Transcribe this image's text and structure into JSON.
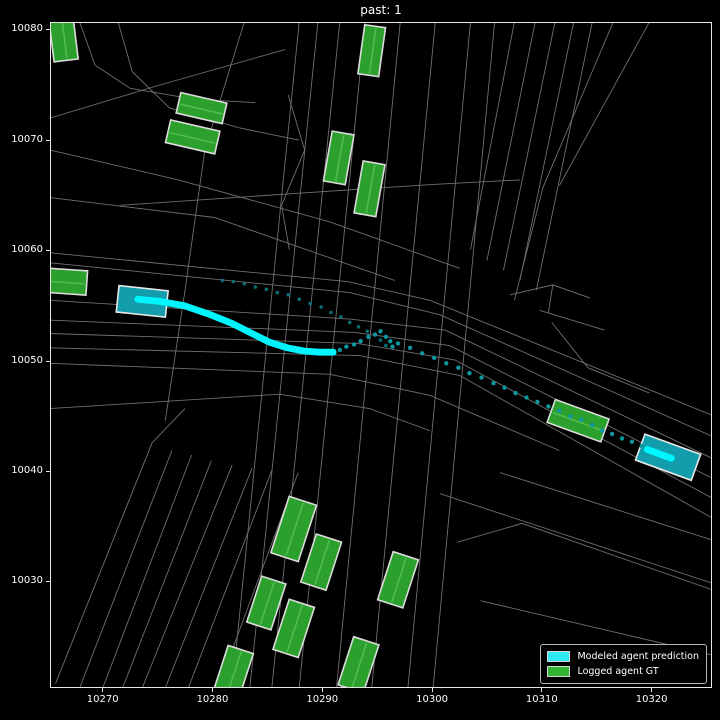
{
  "title": "past: 1",
  "legend": {
    "items": [
      {
        "label": "Modeled agent prediction",
        "color": "#2ee9f4"
      },
      {
        "label": "Logged agent GT",
        "color": "#33b433"
      }
    ]
  },
  "chart_data": {
    "type": "scatter",
    "title": "past: 1",
    "xlim": [
      10265.2,
      10325.5
    ],
    "ylim": [
      10020.4,
      10080.7
    ],
    "xticks": [
      10270,
      10280,
      10290,
      10300,
      10310,
      10320
    ],
    "yticks": [
      10030,
      10040,
      10050,
      10060,
      10070,
      10080
    ],
    "grid": false,
    "legend_position": "lower right",
    "colors": {
      "background": "#000000",
      "road": "#6f6f6f",
      "gt_fill": "#2ca02c",
      "gt_stripe": "#55bf55",
      "gt_edge": "#dcdcdc",
      "pred_fill": "#129cac",
      "pred_edge": "#e8e8e8",
      "pred_bright": "#00f6ff",
      "axis": "#e8e8e8",
      "text": "#ffffff"
    },
    "roads": [
      [
        [
          10265.2,
          10059.8
        ],
        [
          10292.3,
          10057.2
        ],
        [
          10299.8,
          10055.5
        ],
        [
          10325.5,
          10045.1
        ]
      ],
      [
        [
          10265.2,
          10058.9
        ],
        [
          10292.5,
          10056.2
        ],
        [
          10300.7,
          10054.2
        ],
        [
          10325.5,
          10043.2
        ]
      ],
      [
        [
          10265.2,
          10055.5
        ],
        [
          10292.5,
          10053.8
        ],
        [
          10301.2,
          10052.8
        ],
        [
          10325.5,
          10041.2
        ]
      ],
      [
        [
          10265.2,
          10053.7
        ],
        [
          10293.0,
          10052.6
        ],
        [
          10301.6,
          10051.4
        ],
        [
          10325.5,
          10039.4
        ]
      ],
      [
        [
          10265.2,
          10052.5
        ],
        [
          10293.2,
          10051.6
        ],
        [
          10302.1,
          10050.1
        ],
        [
          10325.5,
          10037.6
        ]
      ],
      [
        [
          10265.2,
          10051.2
        ],
        [
          10293.4,
          10050.5
        ],
        [
          10302.5,
          10048.7
        ],
        [
          10325.5,
          10035.8
        ]
      ],
      [
        [
          10265.2,
          10049.8
        ],
        [
          10290.7,
          10048.8
        ],
        [
          10299.8,
          10046.9
        ],
        [
          10311.6,
          10041.9
        ]
      ],
      [
        [
          10265.2,
          10045.7
        ],
        [
          10286.1,
          10047.0
        ],
        [
          10294.3,
          10045.7
        ],
        [
          10299.8,
          10043.7
        ]
      ],
      [
        [
          10300.7,
          10038.0
        ],
        [
          10325.5,
          10029.9
        ]
      ],
      [
        [
          10306.2,
          10039.9
        ],
        [
          10325.5,
          10033.8
        ]
      ],
      [
        [
          10302.3,
          10033.6
        ],
        [
          10308.2,
          10035.3
        ],
        [
          10325.5,
          10029.3
        ]
      ],
      [
        [
          10304.4,
          10028.3
        ],
        [
          10325.5,
          10023.4
        ]
      ],
      [
        [
          10287.9,
          10080.7
        ],
        [
          10281.8,
          10020.4
        ]
      ],
      [
        [
          10289.6,
          10080.7
        ],
        [
          10283.4,
          10020.4
        ]
      ],
      [
        [
          10291.6,
          10080.7
        ],
        [
          10285.4,
          10020.4
        ]
      ],
      [
        [
          10293.9,
          10080.7
        ],
        [
          10287.9,
          10020.4
        ]
      ],
      [
        [
          10297.1,
          10080.7
        ],
        [
          10291.3,
          10020.4
        ]
      ],
      [
        [
          10300.3,
          10080.7
        ],
        [
          10294.5,
          10020.4
        ]
      ],
      [
        [
          10303.5,
          10080.7
        ],
        [
          10297.8,
          10020.4
        ]
      ],
      [
        [
          10305.7,
          10080.7
        ],
        [
          10300.1,
          10020.4
        ]
      ],
      [
        [
          10282.9,
          10080.7
        ],
        [
          10279.3,
          10069.1
        ],
        [
          10277.5,
          10056.4
        ],
        [
          10275.7,
          10044.6
        ]
      ],
      [
        [
          10307.5,
          10080.7
        ],
        [
          10303.5,
          10060.1
        ]
      ],
      [
        [
          10309.4,
          10080.7
        ],
        [
          10305.0,
          10059.1
        ]
      ],
      [
        [
          10311.2,
          10080.7
        ],
        [
          10306.5,
          10058.2
        ]
      ],
      [
        [
          10312.9,
          10080.7
        ],
        [
          10308.0,
          10057.3
        ]
      ],
      [
        [
          10314.6,
          10080.7
        ],
        [
          10309.5,
          10056.4
        ]
      ],
      [
        [
          10316.5,
          10080.7
        ],
        [
          10310.1,
          10065.7
        ],
        [
          10307.5,
          10055.5
        ]
      ],
      [
        [
          10319.8,
          10080.7
        ],
        [
          10311.6,
          10065.9
        ]
      ],
      [
        [
          10277.5,
          10045.7
        ],
        [
          10274.5,
          10042.6
        ],
        [
          10265.7,
          10020.8
        ]
      ],
      [
        [
          10276.3,
          10041.9
        ],
        [
          10267.9,
          10020.4
        ]
      ],
      [
        [
          10278.1,
          10041.5
        ],
        [
          10270.0,
          10020.4
        ]
      ],
      [
        [
          10279.9,
          10041.0
        ],
        [
          10271.8,
          10020.4
        ]
      ],
      [
        [
          10281.8,
          10040.6
        ],
        [
          10273.6,
          10020.4
        ]
      ],
      [
        [
          10283.6,
          10040.3
        ],
        [
          10275.7,
          10020.4
        ]
      ],
      [
        [
          10285.4,
          10040.1
        ],
        [
          10277.8,
          10020.4
        ]
      ],
      [
        [
          10287.8,
          10039.9
        ],
        [
          10280.5,
          10020.4
        ]
      ],
      [
        [
          10265.2,
          10072.0
        ],
        [
          10275.2,
          10075.0
        ],
        [
          10286.6,
          10078.2
        ]
      ],
      [
        [
          10267.9,
          10080.7
        ],
        [
          10269.3,
          10076.8
        ],
        [
          10272.5,
          10074.7
        ],
        [
          10278.4,
          10073.7
        ],
        [
          10283.9,
          10073.4
        ]
      ],
      [
        [
          10271.4,
          10080.7
        ],
        [
          10272.7,
          10076.2
        ],
        [
          10276.1,
          10072.9
        ],
        [
          10282.5,
          10071.1
        ],
        [
          10287.9,
          10070.0
        ]
      ],
      [
        [
          10265.2,
          10069.1
        ],
        [
          10276.9,
          10066.4
        ],
        [
          10290.7,
          10062.6
        ],
        [
          10302.5,
          10058.4
        ]
      ],
      [
        [
          10265.2,
          10064.8
        ],
        [
          10280.2,
          10063.0
        ],
        [
          10293.4,
          10058.4
        ],
        [
          10296.6,
          10057.3
        ]
      ],
      [
        [
          10271.6,
          10064.1
        ],
        [
          10287.9,
          10065.2
        ],
        [
          10300.1,
          10066.0
        ],
        [
          10308.0,
          10066.4
        ]
      ],
      [
        [
          10286.9,
          10074.1
        ],
        [
          10288.4,
          10069.1
        ],
        [
          10286.3,
          10064.1
        ],
        [
          10287.0,
          10060.1
        ]
      ],
      [
        [
          10307.1,
          10056.0
        ],
        [
          10311.0,
          10056.9
        ],
        [
          10314.4,
          10055.7
        ]
      ],
      [
        [
          10311.0,
          10056.9
        ],
        [
          10310.6,
          10054.4
        ]
      ],
      [
        [
          10310.9,
          10053.5
        ],
        [
          10314.2,
          10049.4
        ],
        [
          10319.8,
          10047.1
        ]
      ],
      [
        [
          10309.8,
          10054.6
        ],
        [
          10315.7,
          10052.8
        ]
      ]
    ],
    "gt_boxes": [
      {
        "cx": 10266.4,
        "cy": 10079.4,
        "length": 4.4,
        "width": 2.2,
        "heading": 97
      },
      {
        "cx": 10266.7,
        "cy": 10057.2,
        "length": 3.7,
        "width": 2.2,
        "heading": -4
      },
      {
        "cx": 10279.0,
        "cy": 10072.9,
        "length": 4.3,
        "width": 1.9,
        "heading": -13
      },
      {
        "cx": 10278.2,
        "cy": 10070.3,
        "length": 4.6,
        "width": 2.1,
        "heading": -13
      },
      {
        "cx": 10294.5,
        "cy": 10078.1,
        "length": 4.5,
        "width": 1.9,
        "heading": 82
      },
      {
        "cx": 10291.5,
        "cy": 10068.4,
        "length": 4.6,
        "width": 2.0,
        "heading": 80
      },
      {
        "cx": 10294.3,
        "cy": 10065.6,
        "length": 4.8,
        "width": 2.0,
        "heading": 80
      },
      {
        "cx": 10287.4,
        "cy": 10034.8,
        "length": 5.4,
        "width": 2.6,
        "heading": 72
      },
      {
        "cx": 10289.9,
        "cy": 10031.8,
        "length": 4.6,
        "width": 2.4,
        "heading": 72
      },
      {
        "cx": 10284.9,
        "cy": 10028.1,
        "length": 4.4,
        "width": 2.3,
        "heading": 72
      },
      {
        "cx": 10287.4,
        "cy": 10025.8,
        "length": 4.8,
        "width": 2.4,
        "heading": 72
      },
      {
        "cx": 10296.9,
        "cy": 10030.2,
        "length": 4.6,
        "width": 2.4,
        "heading": 72
      },
      {
        "cx": 10293.3,
        "cy": 10022.5,
        "length": 4.6,
        "width": 2.4,
        "heading": 72
      },
      {
        "cx": 10281.9,
        "cy": 10021.8,
        "length": 4.4,
        "width": 2.4,
        "heading": 72
      },
      {
        "cx": 10313.3,
        "cy": 10044.6,
        "length": 5.2,
        "width": 2.2,
        "heading": -20
      }
    ],
    "pred_boxes": [
      {
        "cx": 10273.6,
        "cy": 10055.4,
        "length": 4.5,
        "width": 2.4,
        "heading": -6
      },
      {
        "cx": 10321.5,
        "cy": 10041.3,
        "length": 5.4,
        "width": 2.5,
        "heading": -20
      }
    ],
    "trajectories": [
      {
        "name": "past-dotted-trajectory",
        "style": "dots",
        "radius": 0.16,
        "color": "#0a6d77",
        "points": [
          [
            10280.9,
            10057.3
          ],
          [
            10281.9,
            10057.2
          ],
          [
            10282.9,
            10057.0
          ],
          [
            10283.9,
            10056.7
          ],
          [
            10284.9,
            10056.5
          ],
          [
            10285.9,
            10056.2
          ],
          [
            10286.9,
            10056.0
          ],
          [
            10287.9,
            10055.6
          ],
          [
            10288.9,
            10055.2
          ],
          [
            10289.9,
            10054.9
          ],
          [
            10290.8,
            10054.4
          ],
          [
            10291.7,
            10054.0
          ],
          [
            10292.5,
            10053.5
          ],
          [
            10293.3,
            10053.1
          ],
          [
            10294.1,
            10052.7
          ],
          [
            10294.8,
            10052.4
          ],
          [
            10295.3,
            10051.9
          ],
          [
            10295.8,
            10051.4
          ]
        ]
      },
      {
        "name": "prediction-path-left",
        "style": "line",
        "width": 0.62,
        "color": "#00f6ff",
        "points": [
          [
            10273.2,
            10055.6
          ],
          [
            10275.2,
            10055.4
          ],
          [
            10277.5,
            10055.0
          ],
          [
            10279.8,
            10054.2
          ],
          [
            10281.8,
            10053.4
          ],
          [
            10283.6,
            10052.5
          ],
          [
            10285.2,
            10051.7
          ],
          [
            10286.8,
            10051.2
          ],
          [
            10288.4,
            10050.9
          ],
          [
            10289.8,
            10050.8
          ],
          [
            10291.0,
            10050.8
          ]
        ]
      },
      {
        "name": "prediction-dots-mid",
        "style": "dots",
        "radius": 0.2,
        "color": "#0f97a1",
        "points": [
          [
            10291.6,
            10051.0
          ],
          [
            10292.2,
            10051.3
          ],
          [
            10292.9,
            10051.5
          ],
          [
            10293.5,
            10051.8
          ],
          [
            10294.2,
            10052.2
          ],
          [
            10294.8,
            10052.4
          ],
          [
            10295.3,
            10052.7
          ],
          [
            10295.8,
            10052.2
          ],
          [
            10296.2,
            10051.8
          ],
          [
            10296.4,
            10051.3
          ]
        ]
      },
      {
        "name": "prediction-dots-main",
        "style": "dots",
        "radius": 0.2,
        "color": "#0f97a1",
        "points": [
          [
            10296.9,
            10051.6
          ],
          [
            10298.0,
            10051.2
          ],
          [
            10299.1,
            10050.7
          ],
          [
            10300.2,
            10050.3
          ],
          [
            10301.3,
            10049.8
          ],
          [
            10302.4,
            10049.4
          ],
          [
            10303.4,
            10048.9
          ],
          [
            10304.5,
            10048.5
          ],
          [
            10305.6,
            10048.0
          ],
          [
            10306.6,
            10047.6
          ],
          [
            10307.6,
            10047.1
          ],
          [
            10308.6,
            10046.7
          ],
          [
            10309.6,
            10046.3
          ],
          [
            10310.6,
            10045.9
          ],
          [
            10311.6,
            10045.5
          ],
          [
            10312.6,
            10045.0
          ],
          [
            10313.6,
            10044.7
          ],
          [
            10314.6,
            10044.2
          ],
          [
            10315.5,
            10043.7
          ],
          [
            10316.4,
            10043.4
          ],
          [
            10317.3,
            10043.0
          ],
          [
            10318.2,
            10042.7
          ],
          [
            10319.1,
            10042.3
          ]
        ]
      },
      {
        "name": "prediction-path-right",
        "style": "line",
        "width": 0.62,
        "color": "#00f6ff",
        "points": [
          [
            10319.6,
            10042.0
          ],
          [
            10321.8,
            10041.2
          ]
        ]
      }
    ]
  }
}
